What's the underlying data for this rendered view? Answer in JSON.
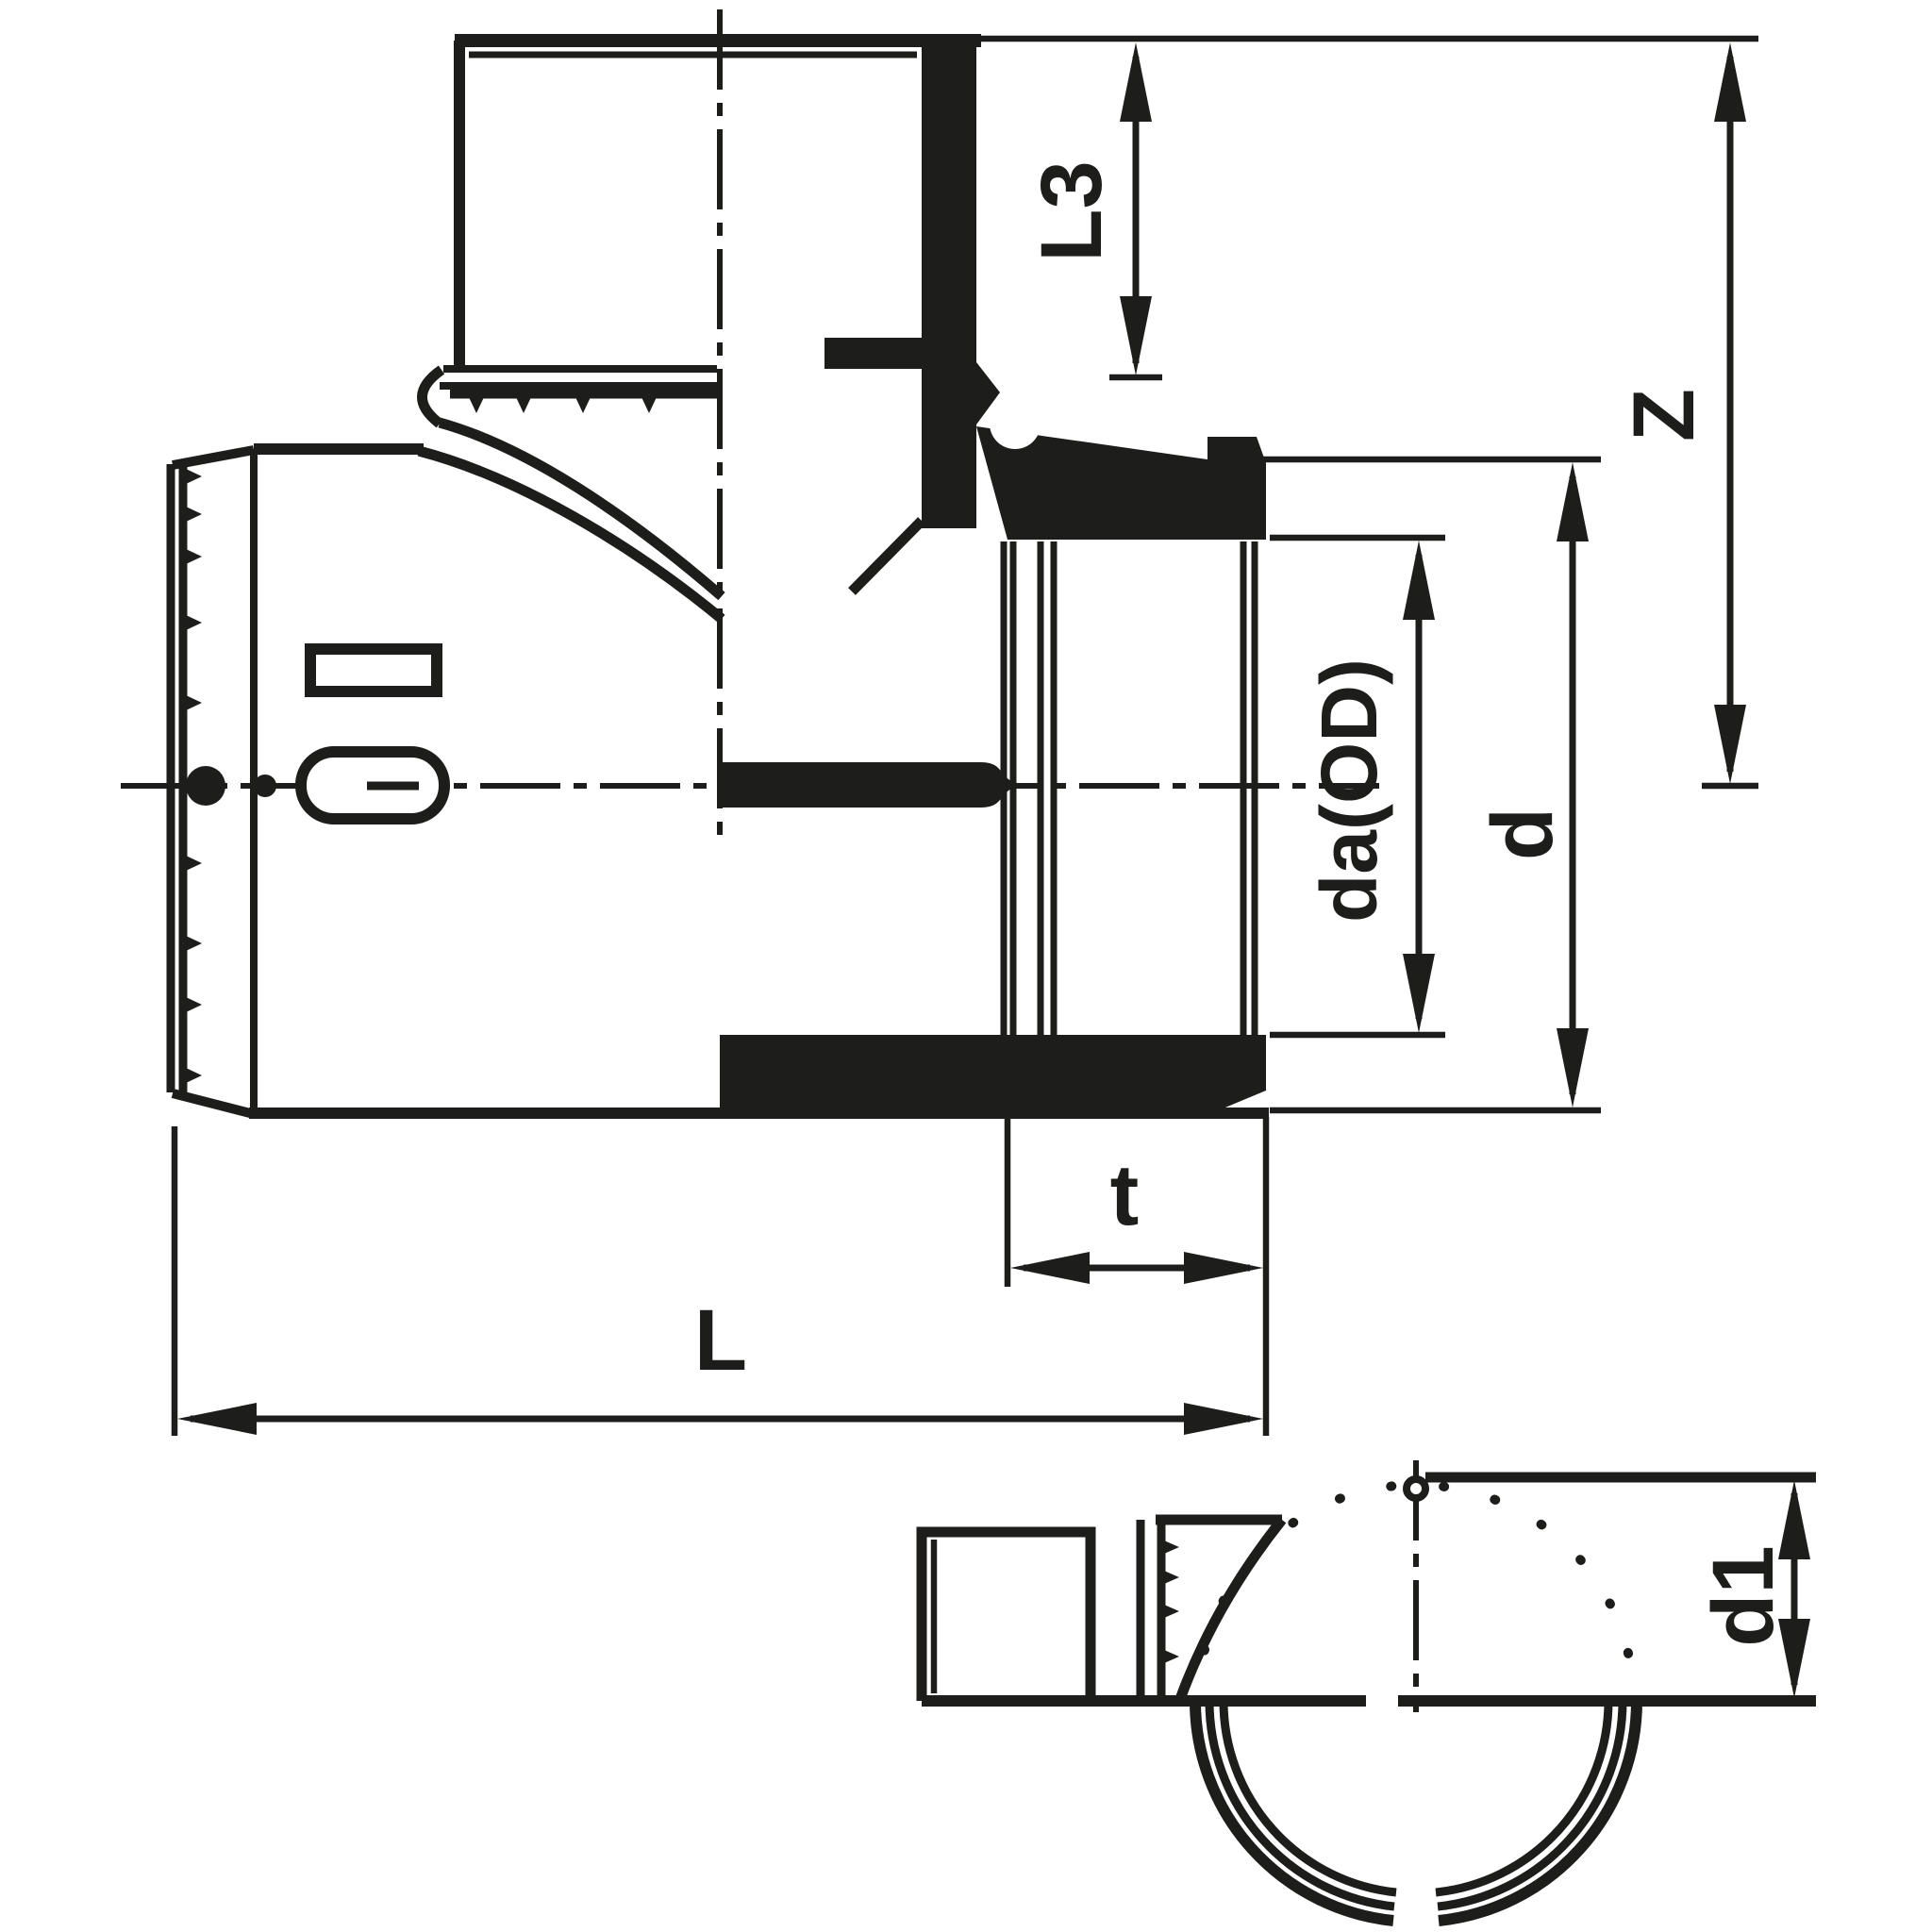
{
  "colors": {
    "ink": "#1d1d1b",
    "background": "#ffffff"
  },
  "dims": {
    "L3": {
      "label": "L3",
      "orientation": "vertical"
    },
    "Z": {
      "label": "Z",
      "orientation": "vertical"
    },
    "daOD": {
      "label": "da(OD)",
      "orientation": "vertical"
    },
    "d": {
      "label": "d",
      "orientation": "vertical"
    },
    "t": {
      "label": "t",
      "orientation": "horizontal"
    },
    "L": {
      "label": "L",
      "orientation": "horizontal"
    },
    "d1": {
      "label": "d1",
      "orientation": "vertical"
    }
  }
}
